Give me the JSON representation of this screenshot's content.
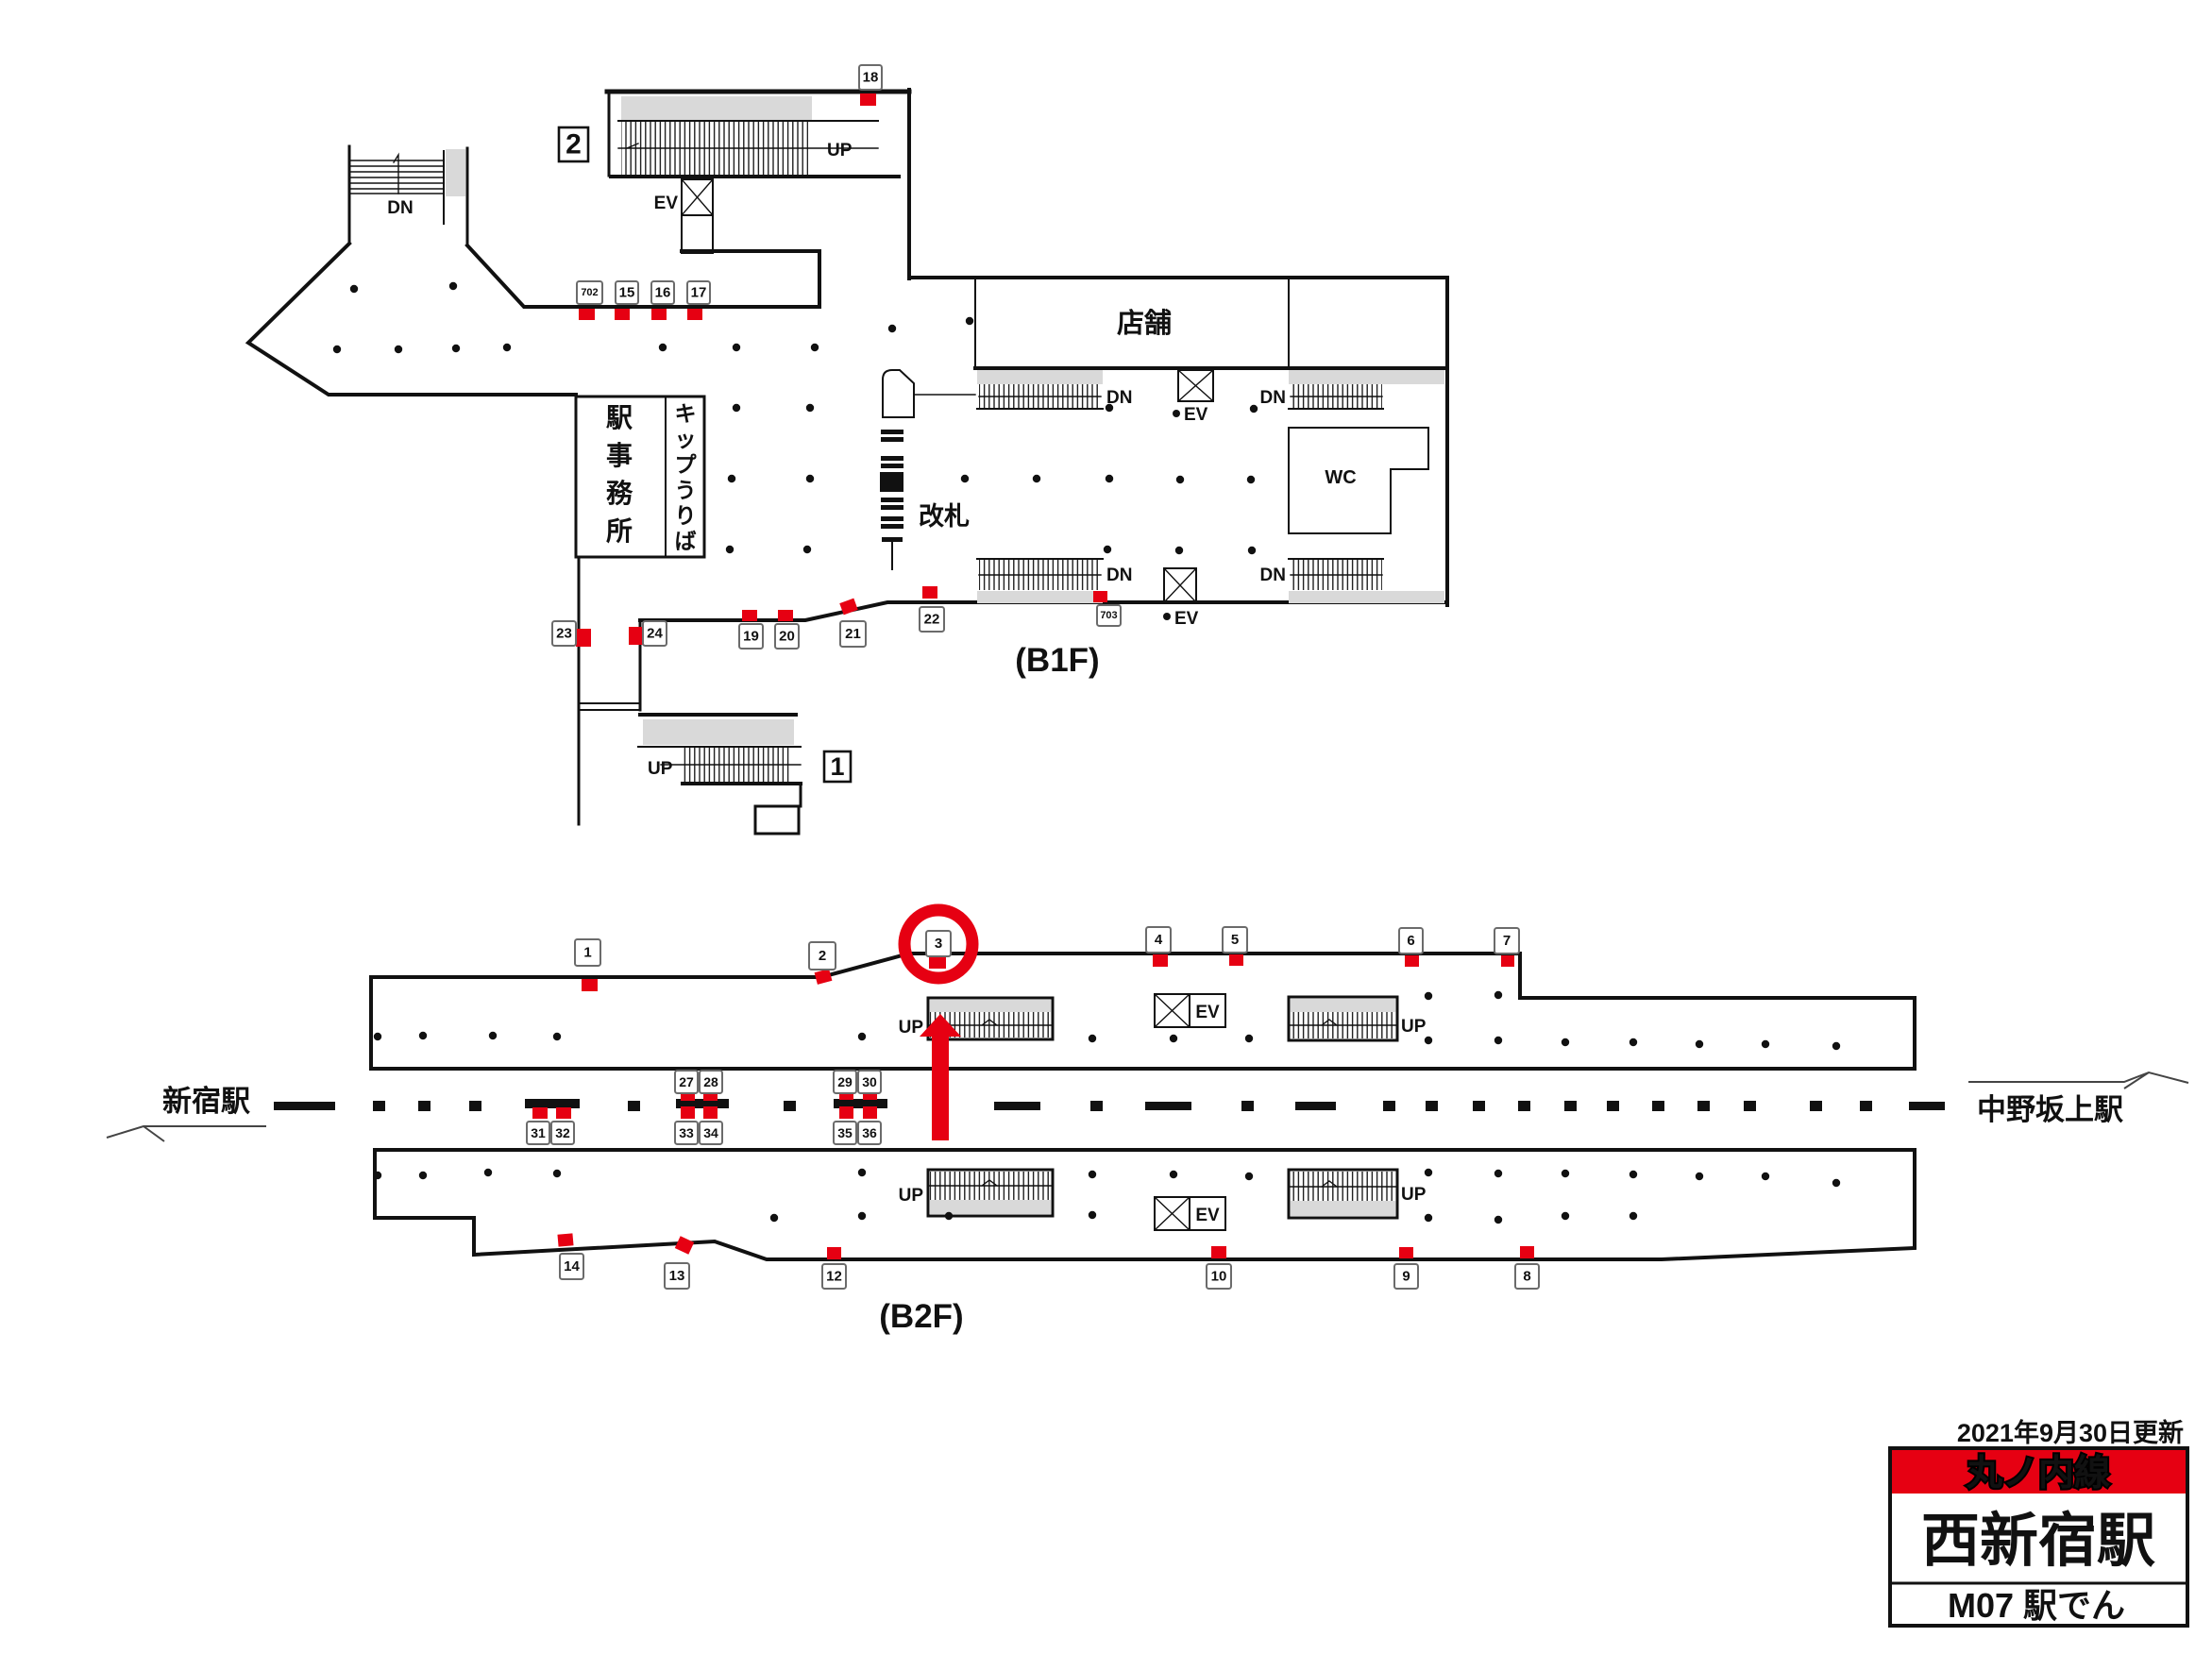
{
  "floors": {
    "b1f": "(B1F)",
    "b2f": "(B2F)"
  },
  "stations": {
    "left": "新宿駅",
    "right": "中野坂上駅"
  },
  "rooms": {
    "office": "駅事務所",
    "tickets": "キップうりば",
    "gate": "改札",
    "shops": "店舗",
    "wc": "WC"
  },
  "dir": {
    "up": "UP",
    "dn": "DN",
    "ev": "EV"
  },
  "legend": {
    "updated": "2021年9月30日更新",
    "line": "丸ノ内線",
    "station": "西新宿駅",
    "code": "M07 駅でん"
  },
  "colors": {
    "red": "#e60012",
    "grey": "#d9d9d9",
    "ink": "#111111"
  },
  "highlight": {
    "circled_position": "3"
  },
  "exits": [
    {
      "label": "2",
      "box": [
        592,
        135,
        31,
        36
      ],
      "fs": 30
    },
    {
      "label": "1",
      "box": [
        873,
        796,
        28,
        32
      ],
      "fs": 27
    }
  ],
  "ad_positions": [
    {
      "no": "18",
      "floor": "B1F",
      "m": [
        911,
        99,
        17,
        13
      ],
      "l": [
        910,
        69,
        24,
        26
      ]
    },
    {
      "no": "702",
      "floor": "B1F",
      "m": [
        613,
        327,
        17,
        12
      ],
      "l": [
        611,
        298,
        27,
        24
      ],
      "fs": 11
    },
    {
      "no": "15",
      "floor": "B1F",
      "m": [
        651,
        327,
        16,
        12
      ],
      "l": [
        652,
        298,
        24,
        24
      ]
    },
    {
      "no": "16",
      "floor": "B1F",
      "m": [
        690,
        327,
        16,
        12
      ],
      "l": [
        690,
        298,
        24,
        24
      ]
    },
    {
      "no": "17",
      "floor": "B1F",
      "m": [
        728,
        327,
        16,
        12
      ],
      "l": [
        728,
        298,
        24,
        24
      ]
    },
    {
      "no": "23",
      "floor": "B1F",
      "m": [
        610,
        666,
        16,
        19
      ],
      "l": [
        585,
        658,
        25,
        26
      ]
    },
    {
      "no": "24",
      "floor": "B1F",
      "m": [
        666,
        664,
        15,
        19
      ],
      "l": [
        681,
        658,
        25,
        26
      ]
    },
    {
      "no": "19",
      "floor": "B1F",
      "m": [
        786,
        646,
        16,
        12
      ],
      "l": [
        783,
        661,
        25,
        26
      ]
    },
    {
      "no": "20",
      "floor": "B1F",
      "m": [
        824,
        646,
        16,
        12
      ],
      "l": [
        821,
        661,
        25,
        26
      ]
    },
    {
      "no": "21",
      "floor": "B1F",
      "m": [
        891,
        636,
        16,
        13
      ],
      "rot": -20,
      "l": [
        890,
        658,
        27,
        27
      ]
    },
    {
      "no": "22",
      "floor": "B1F",
      "m": [
        977,
        621,
        16,
        13
      ],
      "l": [
        974,
        643,
        26,
        26
      ]
    },
    {
      "no": "703",
      "floor": "B1F",
      "m": [
        1158,
        626,
        15,
        12
      ],
      "l": [
        1162,
        641,
        25,
        22
      ],
      "fs": 11
    },
    {
      "no": "1",
      "floor": "B2F",
      "m": [
        616,
        1037,
        17,
        13
      ],
      "l": [
        609,
        995,
        27,
        28
      ]
    },
    {
      "no": "2",
      "floor": "B2F",
      "m": [
        864,
        1028,
        16,
        13
      ],
      "rot": -15,
      "l": [
        857,
        998,
        28,
        29
      ]
    },
    {
      "no": "3",
      "floor": "B2F",
      "m": [
        984,
        1012,
        18,
        14
      ],
      "l": [
        981,
        986,
        26,
        27
      ]
    },
    {
      "no": "4",
      "floor": "B2F",
      "m": [
        1221,
        1011,
        16,
        13
      ],
      "l": [
        1214,
        982,
        26,
        27
      ]
    },
    {
      "no": "5",
      "floor": "B2F",
      "m": [
        1302,
        1011,
        15,
        12
      ],
      "l": [
        1295,
        982,
        26,
        27
      ]
    },
    {
      "no": "6",
      "floor": "B2F",
      "m": [
        1488,
        1012,
        15,
        12
      ],
      "l": [
        1482,
        983,
        25,
        27
      ]
    },
    {
      "no": "7",
      "floor": "B2F",
      "m": [
        1590,
        1012,
        14,
        12
      ],
      "l": [
        1583,
        983,
        26,
        27
      ]
    },
    {
      "no": "14",
      "floor": "B2F",
      "m": [
        591,
        1307,
        16,
        13
      ],
      "rot": -5,
      "l": [
        593,
        1328,
        25,
        27
      ]
    },
    {
      "no": "13",
      "floor": "B2F",
      "m": [
        717,
        1312,
        16,
        14
      ],
      "rot": 25,
      "l": [
        704,
        1338,
        26,
        27
      ]
    },
    {
      "no": "12",
      "floor": "B2F",
      "m": [
        876,
        1321,
        15,
        13
      ],
      "l": [
        871,
        1339,
        25,
        26
      ]
    },
    {
      "no": "10",
      "floor": "B2F",
      "m": [
        1283,
        1320,
        16,
        13
      ],
      "l": [
        1278,
        1339,
        26,
        26
      ]
    },
    {
      "no": "9",
      "floor": "B2F",
      "m": [
        1482,
        1321,
        15,
        12
      ],
      "l": [
        1477,
        1339,
        25,
        26
      ]
    },
    {
      "no": "8",
      "floor": "B2F",
      "m": [
        1610,
        1320,
        15,
        13
      ],
      "l": [
        1605,
        1339,
        25,
        26
      ]
    },
    {
      "no": "27",
      "floor": "B2F",
      "m": [
        721,
        1155,
        15,
        11
      ],
      "l": [
        715,
        1134,
        24,
        24
      ],
      "fs": 14
    },
    {
      "no": "28",
      "floor": "B2F",
      "m": [
        745,
        1155,
        15,
        11
      ],
      "l": [
        741,
        1134,
        24,
        24
      ],
      "fs": 14
    },
    {
      "no": "29",
      "floor": "B2F",
      "m": [
        889,
        1153,
        15,
        12
      ],
      "l": [
        883,
        1134,
        24,
        24
      ],
      "fs": 14
    },
    {
      "no": "30",
      "floor": "B2F",
      "m": [
        914,
        1153,
        15,
        12
      ],
      "l": [
        909,
        1134,
        24,
        24
      ],
      "fs": 14
    },
    {
      "no": "31",
      "floor": "B2F",
      "m": [
        564,
        1173,
        16,
        12
      ],
      "l": [
        558,
        1188,
        24,
        24
      ],
      "fs": 14
    },
    {
      "no": "32",
      "floor": "B2F",
      "m": [
        589,
        1173,
        16,
        12
      ],
      "l": [
        584,
        1188,
        24,
        24
      ],
      "fs": 14
    },
    {
      "no": "33",
      "floor": "B2F",
      "m": [
        721,
        1172,
        15,
        13
      ],
      "l": [
        715,
        1188,
        24,
        24
      ],
      "fs": 14
    },
    {
      "no": "34",
      "floor": "B2F",
      "m": [
        745,
        1172,
        15,
        13
      ],
      "l": [
        741,
        1188,
        24,
        24
      ],
      "fs": 14
    },
    {
      "no": "35",
      "floor": "B2F",
      "m": [
        889,
        1172,
        15,
        13
      ],
      "l": [
        883,
        1188,
        24,
        24
      ],
      "fs": 14
    },
    {
      "no": "36",
      "floor": "B2F",
      "m": [
        914,
        1172,
        15,
        13
      ],
      "l": [
        909,
        1188,
        24,
        24
      ],
      "fs": 14
    }
  ]
}
